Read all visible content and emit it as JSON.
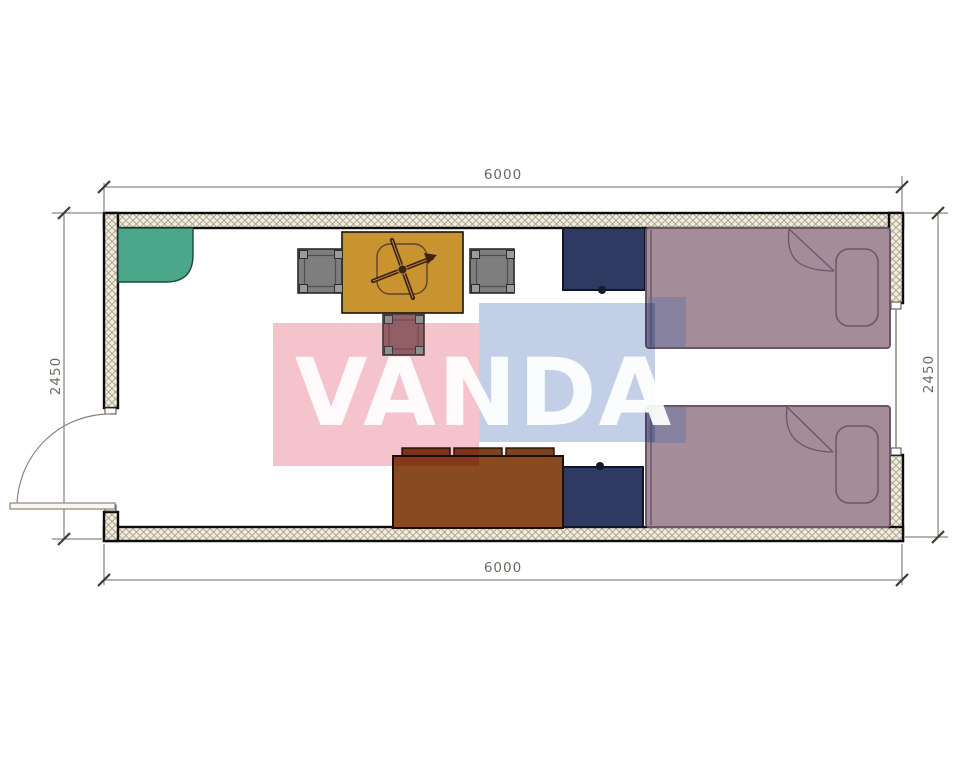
{
  "drawing": {
    "kind": "container-room-floor-plan",
    "watermark": {
      "text": "VANDA"
    },
    "dimensions": {
      "top_width": "6000",
      "bottom_width": "6000",
      "left_height": "2450",
      "right_height": "2450"
    },
    "furniture": [
      {
        "id": "corner-unit-green",
        "color_key": "green_corner_unit"
      },
      {
        "id": "dining-table",
        "color_key": "dining_table"
      },
      {
        "id": "ceiling-fan-symbol",
        "color_key": "fan_dark"
      },
      {
        "id": "chair-left",
        "color_key": "chair_gray"
      },
      {
        "id": "chair-right",
        "color_key": "chair_gray"
      },
      {
        "id": "stool",
        "color_key": "stool_mauve"
      },
      {
        "id": "wardrobe-top",
        "color_key": "cabinet_navy"
      },
      {
        "id": "wardrobe-bottom",
        "color_key": "cabinet_navy"
      },
      {
        "id": "bed-top",
        "color_key": "bed_mauve"
      },
      {
        "id": "bed-bottom",
        "color_key": "bed_mauve"
      },
      {
        "id": "sofa-desk",
        "color_key": "sofa_brown"
      },
      {
        "id": "entry-door"
      },
      {
        "id": "window-right"
      }
    ]
  },
  "palette": {
    "wall_hatch_background": "#f1ecdf",
    "wall_hatch_line": "#a9a28b",
    "wall_outline": "#0d0d0d",
    "green_corner_unit": "#4ca68a",
    "dining_table": "#c9932f",
    "fan_dark": "#3e2410",
    "chair_gray": "#7e7e7e",
    "stool_mauve": "#935f66",
    "cabinet_navy": "#2f3a63",
    "bed_mauve": "#a48c99",
    "bed_blanket_patch": "#5d74a8",
    "sofa_brown": "#8a4a20",
    "watermark_pink": "#f5c3cb",
    "watermark_blue": "#c2cfe6",
    "dimension_text": "#6e6960",
    "dimension_line": "#6e6960",
    "tick_mark": "#3f3a33",
    "door_line": "#8a8578"
  }
}
